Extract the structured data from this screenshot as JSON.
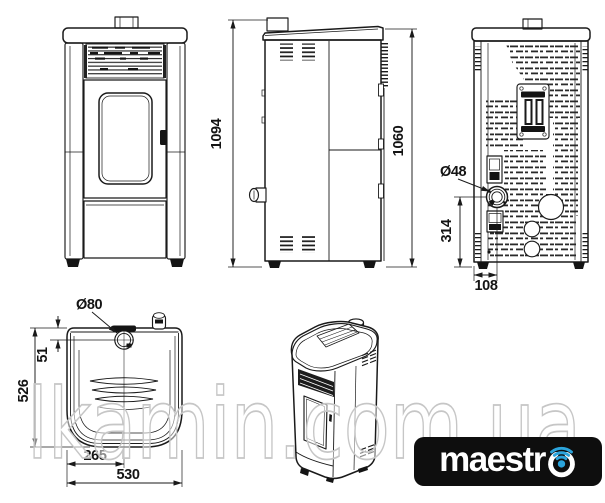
{
  "watermark": {
    "text": "lkamin.com.ua"
  },
  "logo": {
    "brand": "maestro",
    "brand_prefix": "maestr",
    "background_color": "#0e0e0e",
    "text_color": "#ffffff",
    "wifi_color": "#2ba4dc"
  },
  "drawing": {
    "line_color": "#1a1a1a",
    "dimensions": {
      "side_total_height": "1094",
      "side_body_height": "1060",
      "back_flue_diameter": "Ø48",
      "back_flue_center_height": "314",
      "back_flue_center_offset": "108",
      "top_flue_diameter": "Ø80",
      "top_flue_front_offset": "51",
      "top_depth": "526",
      "top_flue_center_offset": "265",
      "top_width": "530"
    }
  }
}
